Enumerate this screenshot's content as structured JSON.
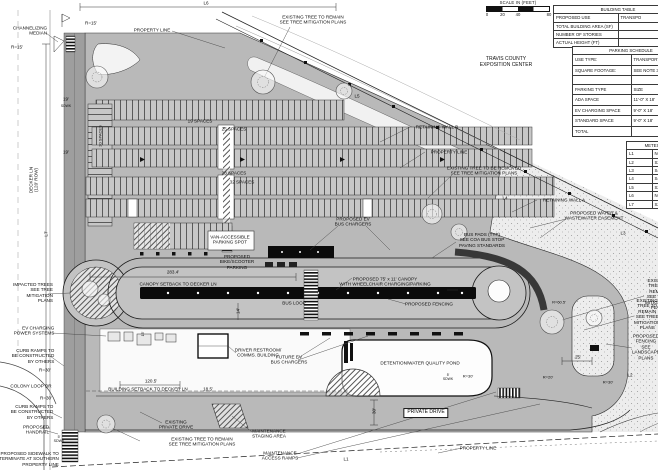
{
  "plan": {
    "scale_bar": {
      "title": "SCALE IN (FEET)",
      "ticks": [
        "0",
        "20",
        "40",
        "80"
      ]
    },
    "building_table": {
      "title": "BUILDING TABLE",
      "rows": [
        [
          "PROPOSED USE",
          "TRANSPO"
        ],
        [
          "TOTAL BUILDING AREA (SF)",
          ""
        ],
        [
          "NUMBER OF STORIES",
          ""
        ],
        [
          "ACTUAL HEIGHT (FT)",
          ""
        ]
      ]
    },
    "parking_schedule": {
      "title": "PARKING SCHEDULE",
      "rows1": [
        [
          "USE TYPE:",
          "TRANSPORTA"
        ],
        [
          "SQUARE FOOTAGE:",
          "SEE NOTE 3"
        ]
      ],
      "col_headers": [
        "PARKING TYPE",
        "SIZE"
      ],
      "rows2": [
        [
          "ADA SPACE",
          "11'-0\" X 18'"
        ],
        [
          "EV CHARGING SPACE",
          "9'-0\" X 18'"
        ],
        [
          "STANDARD SPACE",
          "9'-0\" X 18'"
        ],
        [
          "TOTAL",
          ""
        ]
      ]
    },
    "line_table": {
      "title": "METES",
      "rows": [
        [
          "L1",
          "N62°"
        ],
        [
          "L2",
          "S28°"
        ],
        [
          "L3",
          "S45°"
        ],
        [
          "L4",
          "S45°"
        ],
        [
          "L5",
          "S22°"
        ],
        [
          "L6",
          "N61°"
        ],
        [
          "L7",
          "S27°"
        ]
      ]
    },
    "labels": [
      {
        "n": "label-channelizing-median",
        "t": "CHANNELIZING\nMEDIAN",
        "x": 30,
        "y": 31,
        "ta": "right"
      },
      {
        "n": "label-radius-15-a",
        "t": "R=15'",
        "x": 17,
        "y": 47
      },
      {
        "n": "label-radius-15-b",
        "t": "R=15'",
        "x": 91,
        "y": 23
      },
      {
        "n": "label-property-line-north",
        "t": "PROPERTY LINE",
        "x": 152,
        "y": 30
      },
      {
        "n": "label-line-l6",
        "t": "L6",
        "x": 206,
        "y": 3
      },
      {
        "n": "label-existing-tree-remain-north",
        "t": "EXISTING TREE TO REMAIN\nSEE TREE MITIGATION PLANS",
        "x": 313,
        "y": 20
      },
      {
        "n": "label-travis-county-exposition-center",
        "t": "TRAVIS COUNTY\nEXPOSITION CENTER",
        "x": 506,
        "y": 63,
        "fs": 5
      },
      {
        "n": "label-line-l5",
        "t": "L5",
        "x": 357,
        "y": 96
      },
      {
        "n": "label-retaining-wall-b",
        "t": "RETAINING WALL B",
        "x": 437,
        "y": 127
      },
      {
        "n": "label-property-line-ne",
        "t": "PROPERTY LINE",
        "x": 449,
        "y": 152
      },
      {
        "n": "label-existing-tree-removed",
        "t": "EXISTING TREE TO BE REMOVED\nSEE TREE MITIGATION PLANS",
        "x": 484,
        "y": 171
      },
      {
        "n": "label-line-l4",
        "t": "L4",
        "x": 505,
        "y": 198
      },
      {
        "n": "label-retaining-wall-a",
        "t": "RETAINING WALL A",
        "x": 564,
        "y": 200
      },
      {
        "n": "label-water-wastewater-easement",
        "t": "PROPOSED WATER &\nWASTEWATER EASEMENT",
        "x": 594,
        "y": 216
      },
      {
        "n": "label-line-l3",
        "t": "L3",
        "x": 623,
        "y": 233
      },
      {
        "n": "label-spaces-19",
        "t": "19 SPACES",
        "x": 200,
        "y": 121
      },
      {
        "n": "label-spaces-25",
        "t": "25 SPACES",
        "x": 234,
        "y": 129
      },
      {
        "n": "label-spaces-28",
        "t": "28 SPACES",
        "x": 234,
        "y": 173
      },
      {
        "n": "label-spaces-32",
        "t": "32 SPACES",
        "x": 242,
        "y": 182
      },
      {
        "n": "label-spaces-20",
        "t": "20 SPACES",
        "x": 101,
        "y": 136,
        "r": -90,
        "fs": 4
      },
      {
        "n": "label-van-accessible",
        "t": "VAN-ACCESSIBLE\nPARKING SPOT",
        "x": 230,
        "y": 240
      },
      {
        "n": "label-proposed-ev-bus-chargers",
        "t": "PROPOSED EV\nBUS CHARGERS",
        "x": 353,
        "y": 222
      },
      {
        "n": "label-bike-scooter-parking",
        "t": "PROPOSED\nBIKE/SCOOTER\nPARKING",
        "x": 237,
        "y": 262
      },
      {
        "n": "label-dim-283-4",
        "t": "283.4'",
        "x": 173,
        "y": 272
      },
      {
        "n": "label-canopy-setback",
        "t": "CANOPY SETBACK TO DECKER LN",
        "x": 178,
        "y": 284
      },
      {
        "n": "label-bus-loop",
        "t": "BUS LOOP",
        "x": 294,
        "y": 303
      },
      {
        "n": "label-proposed-canopy",
        "t": "PROPOSED 75' x 11' CANOPY\nWITH WHEELCHAIR CHARGING/PARKING",
        "x": 385,
        "y": 282
      },
      {
        "n": "label-bus-pads",
        "t": "BUS PADS (TYP)\nSEE COA BUS STOP\nPAVING STANDARDS",
        "x": 482,
        "y": 240
      },
      {
        "n": "label-proposed-fencing",
        "t": "PROPOSED FENCING",
        "x": 429,
        "y": 304
      },
      {
        "n": "label-dim-21-5",
        "t": "21.5'",
        "x": 466,
        "y": 290
      },
      {
        "n": "label-radius-60-5",
        "t": "R=60.5'",
        "x": 559,
        "y": 303,
        "fs": 4
      },
      {
        "n": "label-impacted-trees",
        "t": "IMPACTED TREES\nSEE TREE\nMITIGATION\nPLANS",
        "x": 33,
        "y": 293,
        "ta": "right"
      },
      {
        "n": "label-ev-charging-power-systems",
        "t": "EV CHARGING\nPOWER SYSTEMS",
        "x": 34,
        "y": 331,
        "ta": "right"
      },
      {
        "n": "label-curb-ramps-north",
        "t": "CURB RAMPS TO\nBE CONSTRUCTED\nBY OTHERS",
        "x": 33,
        "y": 356,
        "ta": "right"
      },
      {
        "n": "label-radius-30-a",
        "t": "R=30'",
        "x": 45,
        "y": 370
      },
      {
        "n": "label-colony-loop-dr",
        "t": "COLONY LOOP DR",
        "x": 31,
        "y": 386
      },
      {
        "n": "label-radius-30-b",
        "t": "R=30'",
        "x": 46,
        "y": 398
      },
      {
        "n": "label-curb-ramps-south",
        "t": "CURB RAMPS TO\nBE CONSTRUCTED\nBY OTHERS",
        "x": 32,
        "y": 412,
        "ta": "right"
      },
      {
        "n": "label-proposed-handrail",
        "t": "PROPOSED\nHANDRAIL",
        "x": 36,
        "y": 430,
        "ta": "right"
      },
      {
        "n": "label-sdwk-5-west",
        "t": "5'\nSDWK",
        "x": 59,
        "y": 439,
        "fs": 3.6
      },
      {
        "n": "label-sidewalk-terminate",
        "t": "PROPOSED SIDEWALK TO\nTERMINATE AT SOUTHERN\nPROPERTY LINE",
        "x": 29,
        "y": 459,
        "ta": "right"
      },
      {
        "n": "label-decker-ln",
        "t": "DECKER LN\n(120' ROW)",
        "x": 34,
        "y": 180,
        "r": -90
      },
      {
        "n": "label-line-l7",
        "t": "L7",
        "x": 46,
        "y": 234,
        "r": -90
      },
      {
        "n": "label-dim-19-a",
        "t": "19'",
        "x": 66,
        "y": 99
      },
      {
        "n": "label-sdwk-10",
        "t": "SDWK",
        "x": 66,
        "y": 106,
        "fs": 3.4
      },
      {
        "n": "label-dim-19-b",
        "t": "19'",
        "x": 66,
        "y": 152
      },
      {
        "n": "label-driver-restroom-comms",
        "t": "DRIVER RESTROOM/\nCOMMS. BUILDING",
        "x": 258,
        "y": 353
      },
      {
        "n": "label-future-ev-bus-chargers",
        "t": "FUTURE EV\nBUS CHARGERS",
        "x": 289,
        "y": 360
      },
      {
        "n": "label-dim-120-5",
        "t": "120.5'",
        "x": 151,
        "y": 381
      },
      {
        "n": "label-building-setback",
        "t": "BUILDING SETBACK TO DECKER LN",
        "x": 148,
        "y": 389
      },
      {
        "n": "label-dim-18-5",
        "t": "18.5'",
        "x": 208,
        "y": 389
      },
      {
        "n": "label-existing-private-drive",
        "t": "EXISTING\nPRIVATE DRIVE",
        "x": 176,
        "y": 425
      },
      {
        "n": "label-existing-tree-remain-south",
        "t": "EXISTING TREE TO REMAIN\nSEE TREE MITIGATION PLANS",
        "x": 202,
        "y": 442
      },
      {
        "n": "label-maintenance-staging-area",
        "t": "MAINTENANCE\nSTAGING AREA",
        "x": 269,
        "y": 434
      },
      {
        "n": "label-maintenance-access-ramps",
        "t": "MAINTENANCE\nACCESS RAMPS",
        "x": 280,
        "y": 456
      },
      {
        "n": "label-line-l1",
        "t": "L1",
        "x": 346,
        "y": 459
      },
      {
        "n": "label-detention-pond",
        "t": "DETENTION/WATER QUALITY POND",
        "x": 420,
        "y": 363
      },
      {
        "n": "label-radius-30-pond",
        "t": "R=30'",
        "x": 468,
        "y": 377,
        "fs": 4
      },
      {
        "n": "label-sdwk-5-pond",
        "t": "5'\nSDWK",
        "x": 448,
        "y": 377,
        "fs": 3.4
      },
      {
        "n": "label-private-drive",
        "t": "PRIVATE DRIVE",
        "x": 426,
        "y": 413,
        "box": true,
        "fs": 5
      },
      {
        "n": "label-dim-30",
        "t": "30'",
        "x": 374,
        "y": 411,
        "r": -90
      },
      {
        "n": "label-property-line-south",
        "t": "PROPERTY LINE",
        "x": 478,
        "y": 448
      },
      {
        "n": "label-radius-20",
        "t": "R=20'",
        "x": 548,
        "y": 378,
        "fs": 4
      },
      {
        "n": "label-radius-30-se",
        "t": "R=30'",
        "x": 608,
        "y": 383,
        "fs": 4
      },
      {
        "n": "label-dim-25",
        "t": "25'",
        "x": 578,
        "y": 357
      },
      {
        "n": "label-line-l2",
        "t": "L2",
        "x": 630,
        "y": 375
      },
      {
        "n": "label-existing-tree-right-a",
        "t": "EXISTING TREE TO REMAIN\nSEE TREE MITIGATION PLANS",
        "x": 645,
        "y": 294,
        "a": "l"
      },
      {
        "n": "label-existing-tree-right-b",
        "t": "EXISTING TREE TO REMAIN\nSEE TREE MITIGATION PLANS",
        "x": 634,
        "y": 314,
        "a": "l"
      },
      {
        "n": "label-proposed-fencing-right",
        "t": "PROPOSED FENCING\nSEE LANDSCAPE PLANS",
        "x": 632,
        "y": 347,
        "a": "l"
      },
      {
        "n": "label-dim-14",
        "t": "14'",
        "x": 238,
        "y": 311,
        "r": -90
      },
      {
        "n": "label-dim-15",
        "t": "15'",
        "x": 143,
        "y": 334,
        "r": -90,
        "fs": 3.6
      }
    ]
  }
}
